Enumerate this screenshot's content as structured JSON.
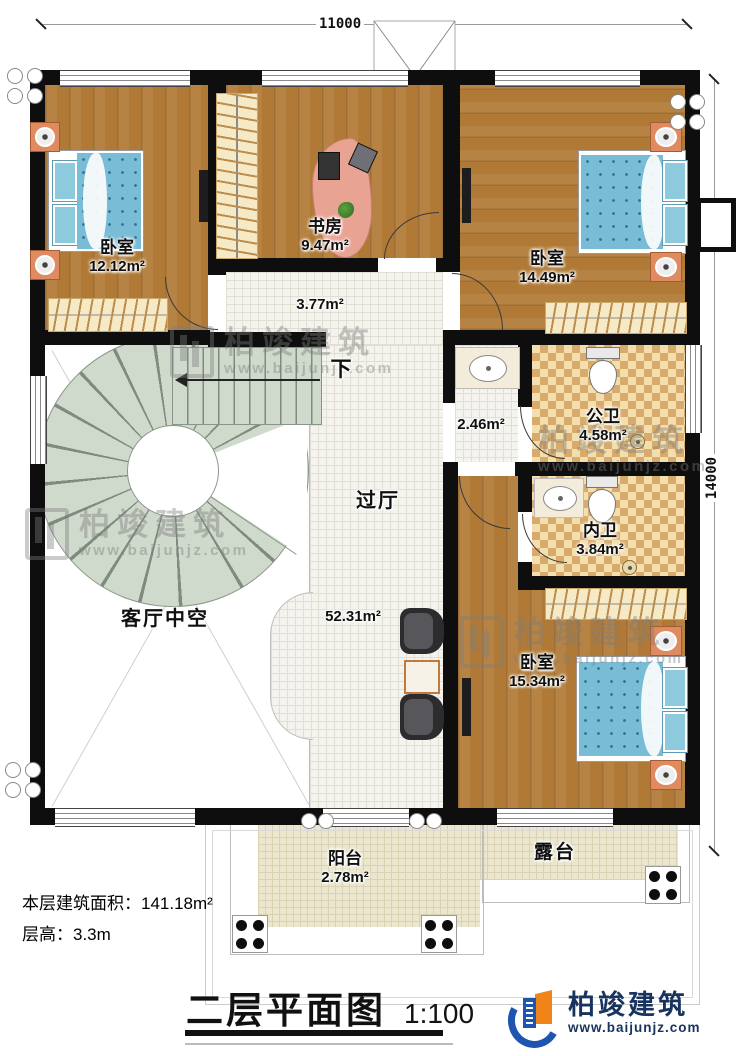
{
  "meta": {
    "dim_top": "11000",
    "dim_right": "14000",
    "area_note": "本层建筑面积：141.18m²",
    "height_note": "层高：3.3m",
    "title": "二层平面图",
    "scale": "1:100"
  },
  "rooms": {
    "bedroom1": {
      "name": "卧室",
      "area": "12.12m²"
    },
    "study": {
      "name": "书房",
      "area": "9.47m²"
    },
    "bedroom2": {
      "name": "卧室",
      "area": "14.49m²"
    },
    "hall_upper": {
      "area": "3.77m²"
    },
    "vanity": {
      "area": "2.46m²"
    },
    "public_bath": {
      "name": "公卫",
      "area": "4.58m²"
    },
    "ensuite_bath": {
      "name": "内卫",
      "area": "3.84m²"
    },
    "hall": {
      "name": "过厅",
      "area": "52.31m²"
    },
    "living_void": {
      "name": "客厅中空"
    },
    "bedroom3": {
      "name": "卧室",
      "area": "15.34m²"
    },
    "balcony": {
      "name": "阳台",
      "area": "2.78m²"
    },
    "terrace": {
      "name": "露台"
    }
  },
  "stairs": {
    "down_label": "下"
  },
  "logo": {
    "name": "柏竣建筑",
    "url": "www.baijunjz.com"
  },
  "watermark": {
    "name": "柏竣建筑",
    "url": "www.baijunjz.com"
  }
}
